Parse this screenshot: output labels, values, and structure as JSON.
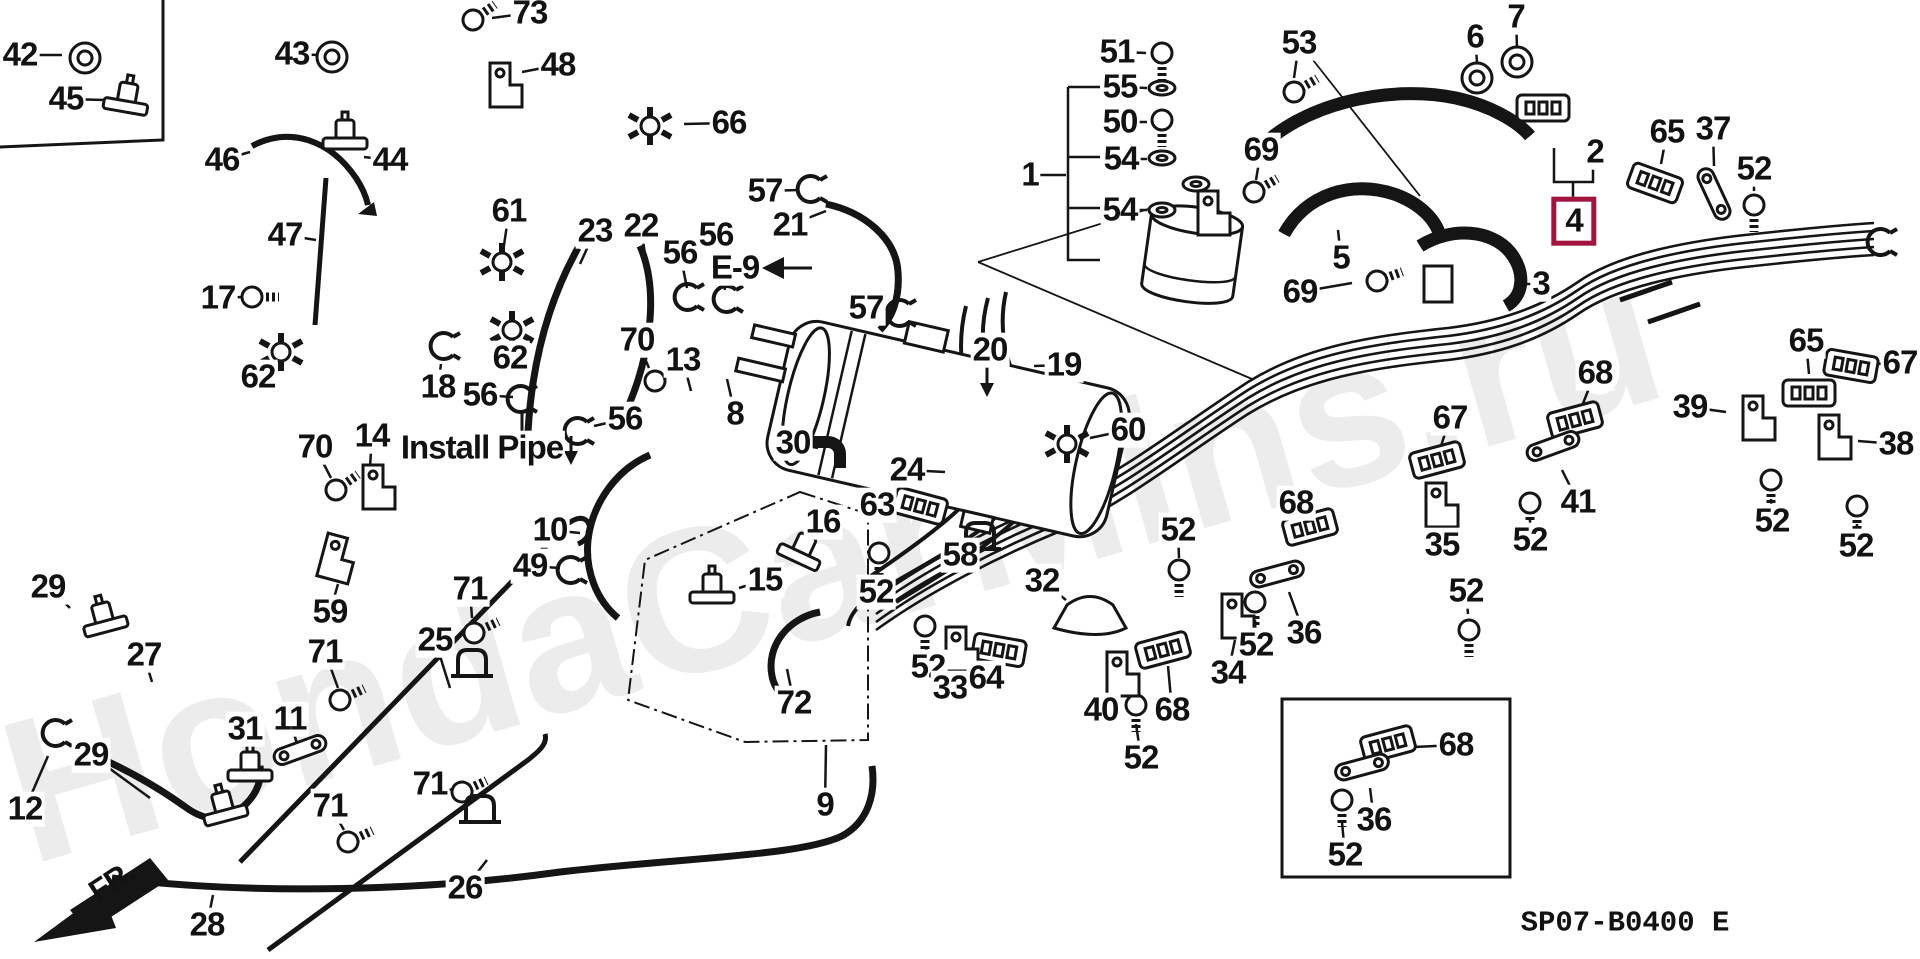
{
  "meta": {
    "watermark": "HondaCarMins.ru",
    "diagram_code": "SP07-B0400 E",
    "highlighted_part": "4",
    "highlight_color": "#a0143f",
    "front_marker": "FR.",
    "install_note": "Install Pipe",
    "connector_ref": "E-9"
  },
  "labels": [
    {
      "text": "42",
      "x": 20,
      "y": 55,
      "lx": 62,
      "ly": 55
    },
    {
      "text": "45",
      "x": 66,
      "y": 99,
      "lx": 105,
      "ly": 100
    },
    {
      "text": "43",
      "x": 292,
      "y": 54,
      "lx": 318,
      "ly": 55
    },
    {
      "text": "73",
      "x": 530,
      "y": 13,
      "lx": 492,
      "ly": 18
    },
    {
      "text": "48",
      "x": 558,
      "y": 65,
      "lx": 522,
      "ly": 72
    },
    {
      "text": "44",
      "x": 390,
      "y": 160,
      "lx": 364,
      "ly": 157
    },
    {
      "text": "46",
      "x": 222,
      "y": 160,
      "lx": 250,
      "ly": 152
    },
    {
      "text": "47",
      "x": 285,
      "y": 235,
      "lx": 316,
      "ly": 240
    },
    {
      "text": "17",
      "x": 218,
      "y": 298,
      "lx": 242,
      "ly": 297
    },
    {
      "text": "66",
      "x": 729,
      "y": 123,
      "lx": 684,
      "ly": 124
    },
    {
      "text": "61",
      "x": 509,
      "y": 211,
      "lx": 503,
      "ly": 252
    },
    {
      "text": "23",
      "x": 595,
      "y": 231,
      "lx": 580,
      "ly": 264
    },
    {
      "text": "22",
      "x": 641,
      "y": 226,
      "lx": 646,
      "ly": 262
    },
    {
      "text": "56",
      "x": 680,
      "y": 253,
      "lx": 687,
      "ly": 288
    },
    {
      "text": "56",
      "x": 716,
      "y": 235,
      "lx": 725,
      "ly": 290
    },
    {
      "text": "57",
      "x": 765,
      "y": 191,
      "lx": 799,
      "ly": 190
    },
    {
      "text": "21",
      "x": 790,
      "y": 225,
      "lx": 826,
      "ly": 211
    },
    {
      "text": "E-9",
      "x": 735,
      "y": 268,
      "style": "ref"
    },
    {
      "text": "57",
      "x": 866,
      "y": 308,
      "lx": 894,
      "ly": 311
    },
    {
      "text": "62",
      "x": 258,
      "y": 377,
      "lx": 277,
      "ly": 361
    },
    {
      "text": "18",
      "x": 438,
      "y": 387,
      "lx": 441,
      "ly": 364
    },
    {
      "text": "62",
      "x": 510,
      "y": 358,
      "lx": 512,
      "ly": 342
    },
    {
      "text": "56",
      "x": 480,
      "y": 395,
      "lx": 513,
      "ly": 397
    },
    {
      "text": "70",
      "x": 315,
      "y": 447,
      "lx": 331,
      "ly": 478
    },
    {
      "text": "14",
      "x": 372,
      "y": 436,
      "lx": 370,
      "ly": 467
    },
    {
      "text": "59",
      "x": 330,
      "y": 612,
      "lx": 338,
      "ly": 584
    },
    {
      "text": "56",
      "x": 625,
      "y": 419,
      "lx": 594,
      "ly": 426
    },
    {
      "text": "Install Pipe",
      "x": 482,
      "y": 448,
      "style": "note"
    },
    {
      "text": "70",
      "x": 637,
      "y": 340,
      "lx": 649,
      "ly": 368
    },
    {
      "text": "13",
      "x": 683,
      "y": 360,
      "lx": 691,
      "ly": 391
    },
    {
      "text": "8",
      "x": 735,
      "y": 414,
      "lx": 727,
      "ly": 379
    },
    {
      "text": "30",
      "x": 793,
      "y": 443,
      "lx": 818,
      "ly": 448
    },
    {
      "text": "24",
      "x": 907,
      "y": 470,
      "lx": 945,
      "ly": 472
    },
    {
      "text": "63",
      "x": 877,
      "y": 505,
      "lx": 905,
      "ly": 505
    },
    {
      "text": "20",
      "x": 990,
      "y": 350
    },
    {
      "text": "19",
      "x": 1064,
      "y": 365,
      "lx": 1034,
      "ly": 366
    },
    {
      "text": "60",
      "x": 1128,
      "y": 430,
      "lx": 1090,
      "ly": 438
    },
    {
      "text": "16",
      "x": 823,
      "y": 522,
      "lx": 812,
      "ly": 545
    },
    {
      "text": "15",
      "x": 765,
      "y": 580,
      "lx": 739,
      "ly": 588
    },
    {
      "text": "49",
      "x": 530,
      "y": 566,
      "lx": 560,
      "ly": 568
    },
    {
      "text": "10",
      "x": 550,
      "y": 530,
      "lx": 580,
      "ly": 533
    },
    {
      "text": "52",
      "x": 876,
      "y": 592,
      "lx": 878,
      "ly": 572
    },
    {
      "text": "58",
      "x": 960,
      "y": 555,
      "lx": 975,
      "ly": 543
    },
    {
      "text": "72",
      "x": 794,
      "y": 703,
      "lx": 787,
      "ly": 669
    },
    {
      "text": "9",
      "x": 825,
      "y": 805,
      "lx": 826,
      "ly": 745
    },
    {
      "text": "52",
      "x": 928,
      "y": 667,
      "lx": 926,
      "ly": 646
    },
    {
      "text": "33",
      "x": 950,
      "y": 688,
      "lx": 957,
      "ly": 666
    },
    {
      "text": "64",
      "x": 986,
      "y": 678,
      "lx": 997,
      "ly": 661
    },
    {
      "text": "32",
      "x": 1042,
      "y": 581,
      "lx": 1066,
      "ly": 600
    },
    {
      "text": "52",
      "x": 1178,
      "y": 530,
      "lx": 1179,
      "ly": 558
    },
    {
      "text": "68",
      "x": 1296,
      "y": 503,
      "lx": 1305,
      "ly": 519
    },
    {
      "text": "36",
      "x": 1304,
      "y": 633,
      "lx": 1289,
      "ly": 592
    },
    {
      "text": "52",
      "x": 1256,
      "y": 645,
      "lx": 1255,
      "ly": 620
    },
    {
      "text": "34",
      "x": 1228,
      "y": 673,
      "lx": 1235,
      "ly": 640
    },
    {
      "text": "40",
      "x": 1101,
      "y": 710,
      "lx": 1117,
      "ly": 690
    },
    {
      "text": "68",
      "x": 1172,
      "y": 710,
      "lx": 1168,
      "ly": 666
    },
    {
      "text": "52",
      "x": 1141,
      "y": 758,
      "lx": 1136,
      "ly": 724
    },
    {
      "text": "35",
      "x": 1442,
      "y": 545,
      "lx": 1440,
      "ly": 521
    },
    {
      "text": "67",
      "x": 1450,
      "y": 418,
      "lx": 1441,
      "ly": 446
    },
    {
      "text": "52",
      "x": 1466,
      "y": 591,
      "lx": 1468,
      "ly": 614
    },
    {
      "text": "41",
      "x": 1578,
      "y": 502,
      "lx": 1562,
      "ly": 470
    },
    {
      "text": "52",
      "x": 1530,
      "y": 540,
      "lx": 1530,
      "ly": 520
    },
    {
      "text": "68",
      "x": 1595,
      "y": 373,
      "lx": 1582,
      "ly": 406
    },
    {
      "text": "39",
      "x": 1690,
      "y": 407,
      "lx": 1726,
      "ly": 412
    },
    {
      "text": "65",
      "x": 1806,
      "y": 341,
      "lx": 1809,
      "ly": 374
    },
    {
      "text": "67",
      "x": 1900,
      "y": 363,
      "lx": 1874,
      "ly": 364
    },
    {
      "text": "38",
      "x": 1896,
      "y": 444,
      "lx": 1858,
      "ly": 441
    },
    {
      "text": "52",
      "x": 1772,
      "y": 521,
      "lx": 1771,
      "ly": 499
    },
    {
      "text": "52",
      "x": 1856,
      "y": 546,
      "lx": 1857,
      "ly": 524
    },
    {
      "text": "65",
      "x": 1667,
      "y": 132,
      "lx": 1661,
      "ly": 164
    },
    {
      "text": "37",
      "x": 1713,
      "y": 129,
      "lx": 1714,
      "ly": 166
    },
    {
      "text": "52",
      "x": 1754,
      "y": 169,
      "lx": 1754,
      "ly": 191
    },
    {
      "text": "51",
      "x": 1117,
      "y": 52,
      "lx": 1146,
      "ly": 53
    },
    {
      "text": "55",
      "x": 1120,
      "y": 87,
      "lx": 1147,
      "ly": 88
    },
    {
      "text": "50",
      "x": 1120,
      "y": 122,
      "lx": 1147,
      "ly": 122
    },
    {
      "text": "54",
      "x": 1121,
      "y": 159,
      "lx": 1147,
      "ly": 159
    },
    {
      "text": "54",
      "x": 1120,
      "y": 210,
      "lx": 1147,
      "ly": 210
    },
    {
      "text": "1",
      "x": 1030,
      "y": 175,
      "lx": 1066,
      "ly": 175
    },
    {
      "text": "53",
      "x": 1299,
      "y": 43,
      "lx": 1294,
      "ly": 78
    },
    {
      "text": "69",
      "x": 1261,
      "y": 150,
      "lx": 1256,
      "ly": 180
    },
    {
      "text": "69",
      "x": 1300,
      "y": 292,
      "lx": 1352,
      "ly": 283
    },
    {
      "text": "6",
      "x": 1475,
      "y": 37,
      "lx": 1477,
      "ly": 62
    },
    {
      "text": "7",
      "x": 1516,
      "y": 17,
      "lx": 1517,
      "ly": 48
    },
    {
      "text": "2",
      "x": 1595,
      "y": 152
    },
    {
      "text": "4",
      "x": 1574,
      "y": 221,
      "style": "boxed"
    },
    {
      "text": "5",
      "x": 1341,
      "y": 258,
      "lx": 1338,
      "ly": 230
    },
    {
      "text": "3",
      "x": 1541,
      "y": 284,
      "lx": 1514,
      "ly": 284
    },
    {
      "text": "29",
      "x": 48,
      "y": 587,
      "lx": 70,
      "ly": 608
    },
    {
      "text": "27",
      "x": 144,
      "y": 655,
      "lx": 152,
      "ly": 682
    },
    {
      "text": "12",
      "x": 25,
      "y": 809,
      "lx": 48,
      "ly": 756
    },
    {
      "text": "29",
      "x": 91,
      "y": 755,
      "lx": 150,
      "ly": 798
    },
    {
      "text": "28",
      "x": 207,
      "y": 925,
      "lx": 213,
      "ly": 895
    },
    {
      "text": "31",
      "x": 245,
      "y": 729,
      "lx": 250,
      "ly": 754
    },
    {
      "text": "11",
      "x": 290,
      "y": 719,
      "lx": 297,
      "ly": 744
    },
    {
      "text": "71",
      "x": 470,
      "y": 589,
      "lx": 472,
      "ly": 618
    },
    {
      "text": "25",
      "x": 435,
      "y": 640,
      "lx": 450,
      "ly": 688
    },
    {
      "text": "71",
      "x": 325,
      "y": 652,
      "lx": 338,
      "ly": 688
    },
    {
      "text": "71",
      "x": 430,
      "y": 784,
      "lx": 452,
      "ly": 790
    },
    {
      "text": "71",
      "x": 330,
      "y": 806,
      "lx": 344,
      "ly": 830
    },
    {
      "text": "26",
      "x": 465,
      "y": 888,
      "lx": 487,
      "ly": 860
    },
    {
      "text": "FR.",
      "x": 112,
      "y": 882,
      "style": "fr"
    },
    {
      "text": "68",
      "x": 1456,
      "y": 745,
      "lx": 1414,
      "ly": 747
    },
    {
      "text": "36",
      "x": 1374,
      "y": 820,
      "lx": 1370,
      "ly": 788
    },
    {
      "text": "52",
      "x": 1345,
      "y": 855,
      "lx": 1342,
      "ly": 822
    },
    {
      "text": "SP07-B0400 E",
      "x": 1625,
      "y": 923,
      "style": "code"
    }
  ],
  "parts": [
    {
      "type": "grommet",
      "x": 85,
      "y": 58
    },
    {
      "type": "grommet",
      "x": 332,
      "y": 57
    },
    {
      "type": "grommet",
      "x": 1477,
      "y": 78
    },
    {
      "type": "grommet",
      "x": 1517,
      "y": 62
    },
    {
      "type": "block",
      "x": 1543,
      "y": 108,
      "r": 0
    },
    {
      "type": "valveT",
      "x": 126,
      "y": 103,
      "r": 10
    },
    {
      "type": "valveT",
      "x": 345,
      "y": 140,
      "r": 0
    },
    {
      "type": "valveT",
      "x": 712,
      "y": 594,
      "r": 0
    },
    {
      "type": "valveT",
      "x": 800,
      "y": 554,
      "r": 25
    },
    {
      "type": "valveT",
      "x": 105,
      "y": 623,
      "r": -15
    },
    {
      "type": "valveT",
      "x": 225,
      "y": 812,
      "r": -15
    },
    {
      "type": "valveT",
      "x": 250,
      "y": 772,
      "r": 0
    },
    {
      "type": "bolt",
      "x": 473,
      "y": 20,
      "r": -35
    },
    {
      "type": "bolt",
      "x": 252,
      "y": 297,
      "r": 0
    },
    {
      "type": "bolt",
      "x": 336,
      "y": 490,
      "r": -35
    },
    {
      "type": "bolt",
      "x": 655,
      "y": 381,
      "r": -35
    },
    {
      "type": "bolt",
      "x": 1294,
      "y": 92,
      "r": -30
    },
    {
      "type": "bolt",
      "x": 1254,
      "y": 192,
      "r": -30
    },
    {
      "type": "bolt",
      "x": 1377,
      "y": 281,
      "r": -20
    },
    {
      "type": "bolt",
      "x": 474,
      "y": 633,
      "r": -25
    },
    {
      "type": "bolt",
      "x": 340,
      "y": 700,
      "r": -25
    },
    {
      "type": "bolt",
      "x": 462,
      "y": 792,
      "r": -25
    },
    {
      "type": "bolt",
      "x": 348,
      "y": 842,
      "r": -25
    },
    {
      "type": "bolt",
      "x": 879,
      "y": 553,
      "r": 90
    },
    {
      "type": "bolt",
      "x": 925,
      "y": 626,
      "r": 90
    },
    {
      "type": "bolt",
      "x": 1179,
      "y": 570,
      "r": 90
    },
    {
      "type": "bolt",
      "x": 1255,
      "y": 602,
      "r": 90
    },
    {
      "type": "bolt",
      "x": 1136,
      "y": 705,
      "r": 90
    },
    {
      "type": "bolt",
      "x": 1469,
      "y": 630,
      "r": 90
    },
    {
      "type": "bolt",
      "x": 1530,
      "y": 503,
      "r": 90
    },
    {
      "type": "bolt",
      "x": 1771,
      "y": 480,
      "r": 90
    },
    {
      "type": "bolt",
      "x": 1857,
      "y": 506,
      "r": 90
    },
    {
      "type": "bolt",
      "x": 1754,
      "y": 205,
      "r": 90
    },
    {
      "type": "bolt",
      "x": 1342,
      "y": 800,
      "r": 90
    },
    {
      "type": "bolt",
      "x": 1162,
      "y": 53,
      "r": 90
    },
    {
      "type": "bolt",
      "x": 1162,
      "y": 120,
      "r": 90
    },
    {
      "type": "washer",
      "x": 1162,
      "y": 88
    },
    {
      "type": "washer",
      "x": 1162,
      "y": 158
    },
    {
      "type": "washer",
      "x": 1162,
      "y": 210
    },
    {
      "type": "washer",
      "x": 1196,
      "y": 184
    },
    {
      "type": "clampC",
      "x": 810,
      "y": 189
    },
    {
      "type": "clampC",
      "x": 899,
      "y": 313
    },
    {
      "type": "clampC",
      "x": 687,
      "y": 297
    },
    {
      "type": "clampC",
      "x": 726,
      "y": 299
    },
    {
      "type": "clampC",
      "x": 520,
      "y": 399
    },
    {
      "type": "clampC",
      "x": 577,
      "y": 431
    },
    {
      "type": "clampC",
      "x": 443,
      "y": 346
    },
    {
      "type": "clampC",
      "x": 570,
      "y": 570
    },
    {
      "type": "clampC",
      "x": 55,
      "y": 733
    },
    {
      "type": "clampC",
      "x": 1880,
      "y": 242
    },
    {
      "type": "starclamp",
      "x": 650,
      "y": 126
    },
    {
      "type": "starclamp",
      "x": 502,
      "y": 262
    },
    {
      "type": "starclamp",
      "x": 281,
      "y": 352
    },
    {
      "type": "starclamp",
      "x": 512,
      "y": 330
    },
    {
      "type": "starclamp",
      "x": 1067,
      "y": 444
    },
    {
      "type": "block",
      "x": 920,
      "y": 506,
      "r": 15
    },
    {
      "type": "block",
      "x": 999,
      "y": 650,
      "r": 10
    },
    {
      "type": "block",
      "x": 1310,
      "y": 527,
      "r": -15
    },
    {
      "type": "block",
      "x": 1163,
      "y": 650,
      "r": -15
    },
    {
      "type": "block",
      "x": 1575,
      "y": 420,
      "r": -15
    },
    {
      "type": "block",
      "x": 1388,
      "y": 744,
      "r": -15
    },
    {
      "type": "block",
      "x": 1437,
      "y": 460,
      "r": -15
    },
    {
      "type": "block",
      "x": 1851,
      "y": 366,
      "r": 10
    },
    {
      "type": "block",
      "x": 1655,
      "y": 183,
      "r": 20
    },
    {
      "type": "block",
      "x": 1809,
      "y": 393,
      "r": 0
    },
    {
      "type": "strap",
      "x": 1277,
      "y": 574,
      "r": -15
    },
    {
      "type": "strap",
      "x": 1362,
      "y": 767,
      "r": -15
    },
    {
      "type": "strap",
      "x": 1553,
      "y": 446,
      "r": -20
    },
    {
      "type": "strap",
      "x": 1714,
      "y": 194,
      "r": 65
    },
    {
      "type": "strap",
      "x": 300,
      "y": 750,
      "r": -20
    },
    {
      "type": "bracketL",
      "x": 504,
      "y": 85,
      "r": 0
    },
    {
      "type": "bracketL",
      "x": 377,
      "y": 487,
      "r": 0
    },
    {
      "type": "bracketL",
      "x": 336,
      "y": 558,
      "r": 15
    },
    {
      "type": "bracketL",
      "x": 960,
      "y": 649,
      "r": 0
    },
    {
      "type": "bracketL",
      "x": 1121,
      "y": 674,
      "r": 0
    },
    {
      "type": "bracketL",
      "x": 1236,
      "y": 616,
      "r": 0
    },
    {
      "type": "bracketL",
      "x": 1440,
      "y": 505,
      "r": 0
    },
    {
      "type": "bracketL",
      "x": 1757,
      "y": 418,
      "r": 0
    },
    {
      "type": "bracketL",
      "x": 1833,
      "y": 437,
      "r": 0
    },
    {
      "type": "bracketL",
      "x": 1212,
      "y": 213,
      "r": 0
    },
    {
      "type": "clip",
      "x": 980,
      "y": 537
    },
    {
      "type": "clip",
      "x": 472,
      "y": 664
    },
    {
      "type": "clip",
      "x": 480,
      "y": 810
    },
    {
      "type": "saddle",
      "x": 1090,
      "y": 612
    },
    {
      "type": "elbow",
      "x": 826,
      "y": 452
    }
  ]
}
